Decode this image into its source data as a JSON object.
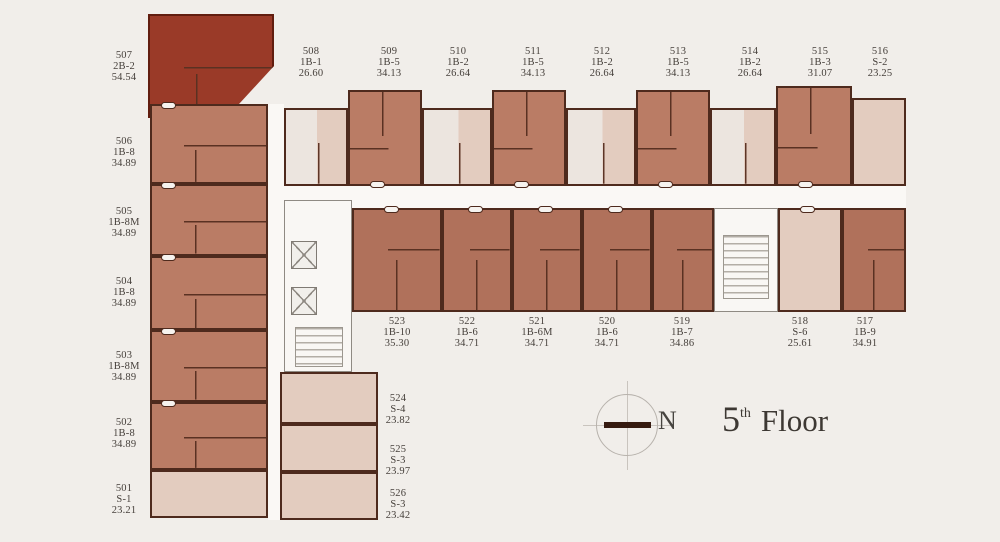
{
  "floor": {
    "number": "5",
    "ordinal": "th",
    "word": "Floor"
  },
  "compass": {
    "north": "N"
  },
  "units": {
    "u501": {
      "no": "501",
      "type": "S-1",
      "area": "23.21"
    },
    "u502": {
      "no": "502",
      "type": "1B-8",
      "area": "34.89"
    },
    "u503": {
      "no": "503",
      "type": "1B-8M",
      "area": "34.89"
    },
    "u504": {
      "no": "504",
      "type": "1B-8",
      "area": "34.89"
    },
    "u505": {
      "no": "505",
      "type": "1B-8M",
      "area": "34.89"
    },
    "u506": {
      "no": "506",
      "type": "1B-8",
      "area": "34.89"
    },
    "u507": {
      "no": "507",
      "type": "2B-2",
      "area": "54.54"
    },
    "u508": {
      "no": "508",
      "type": "1B-1",
      "area": "26.60"
    },
    "u509": {
      "no": "509",
      "type": "1B-5",
      "area": "34.13"
    },
    "u510": {
      "no": "510",
      "type": "1B-2",
      "area": "26.64"
    },
    "u511": {
      "no": "511",
      "type": "1B-5",
      "area": "34.13"
    },
    "u512": {
      "no": "512",
      "type": "1B-2",
      "area": "26.64"
    },
    "u513": {
      "no": "513",
      "type": "1B-5",
      "area": "34.13"
    },
    "u514": {
      "no": "514",
      "type": "1B-2",
      "area": "26.64"
    },
    "u515": {
      "no": "515",
      "type": "1B-3",
      "area": "31.07"
    },
    "u516": {
      "no": "516",
      "type": "S-2",
      "area": "23.25"
    },
    "u517": {
      "no": "517",
      "type": "1B-9",
      "area": "34.91"
    },
    "u518": {
      "no": "518",
      "type": "S-6",
      "area": "25.61"
    },
    "u519": {
      "no": "519",
      "type": "1B-7",
      "area": "34.86"
    },
    "u520": {
      "no": "520",
      "type": "1B-6",
      "area": "34.71"
    },
    "u521": {
      "no": "521",
      "type": "1B-6M",
      "area": "34.71"
    },
    "u522": {
      "no": "522",
      "type": "1B-6",
      "area": "34.71"
    },
    "u523": {
      "no": "523",
      "type": "1B-10",
      "area": "35.30"
    },
    "u524": {
      "no": "524",
      "type": "S-4",
      "area": "23.82"
    },
    "u525": {
      "no": "525",
      "type": "S-3",
      "area": "23.97"
    },
    "u526": {
      "no": "526",
      "type": "S-3",
      "area": "23.42"
    }
  },
  "colors": {
    "highlight_unit": "#9a3a28",
    "one_bed": "#ba7c65",
    "one_bed_dark": "#b0715b",
    "studio_light": "#e3ccbf",
    "wall": "#4e2a1d"
  }
}
